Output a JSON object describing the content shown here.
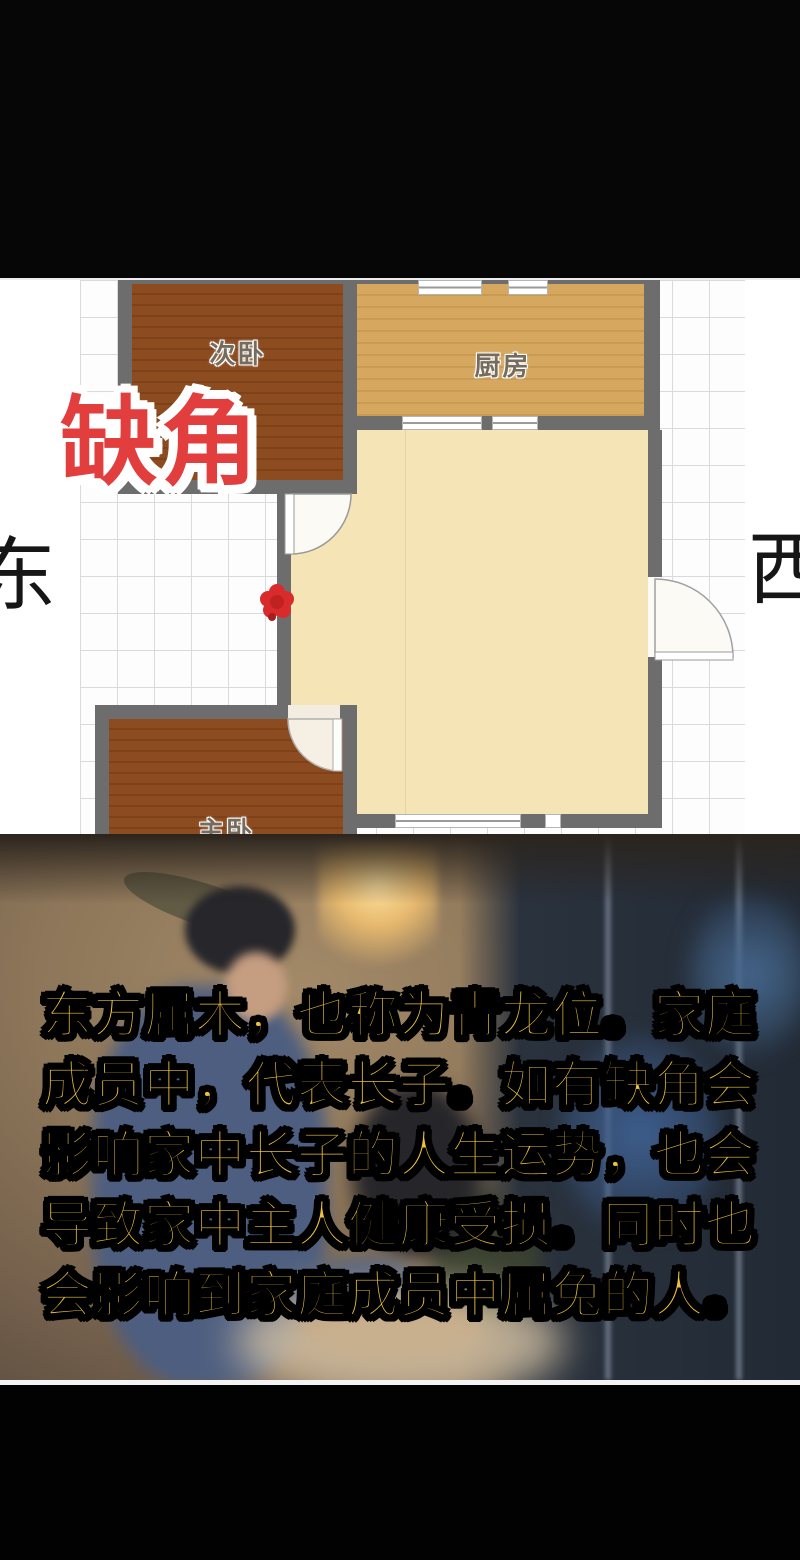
{
  "floor_plan": {
    "annotation": "缺角",
    "direction_left": "东",
    "direction_right": "西",
    "rooms": [
      {
        "label": "次卧"
      },
      {
        "label": "厨房"
      },
      {
        "label": "客餐厅"
      },
      {
        "label": "主卧"
      }
    ],
    "marker": "red-flower-star",
    "colors": {
      "annotation_red": "#e23e3e",
      "bedroom_floor": "#8d4b20",
      "kitchen_floor": "#d5a75f",
      "living_floor": "#f5e4b5",
      "wall_gray": "#6d6d6d",
      "marker_red": "#d92b2b"
    }
  },
  "caption": {
    "text_color": "#edc23a",
    "lines": [
      "东方属木，也称为青龙位。家庭",
      "成员中，代表长子。如有缺角会",
      "影响家中长子的人生运势，也会",
      "导致家中主人健康受损。同时也",
      "会影响到家庭成员中属兔的人。"
    ]
  }
}
